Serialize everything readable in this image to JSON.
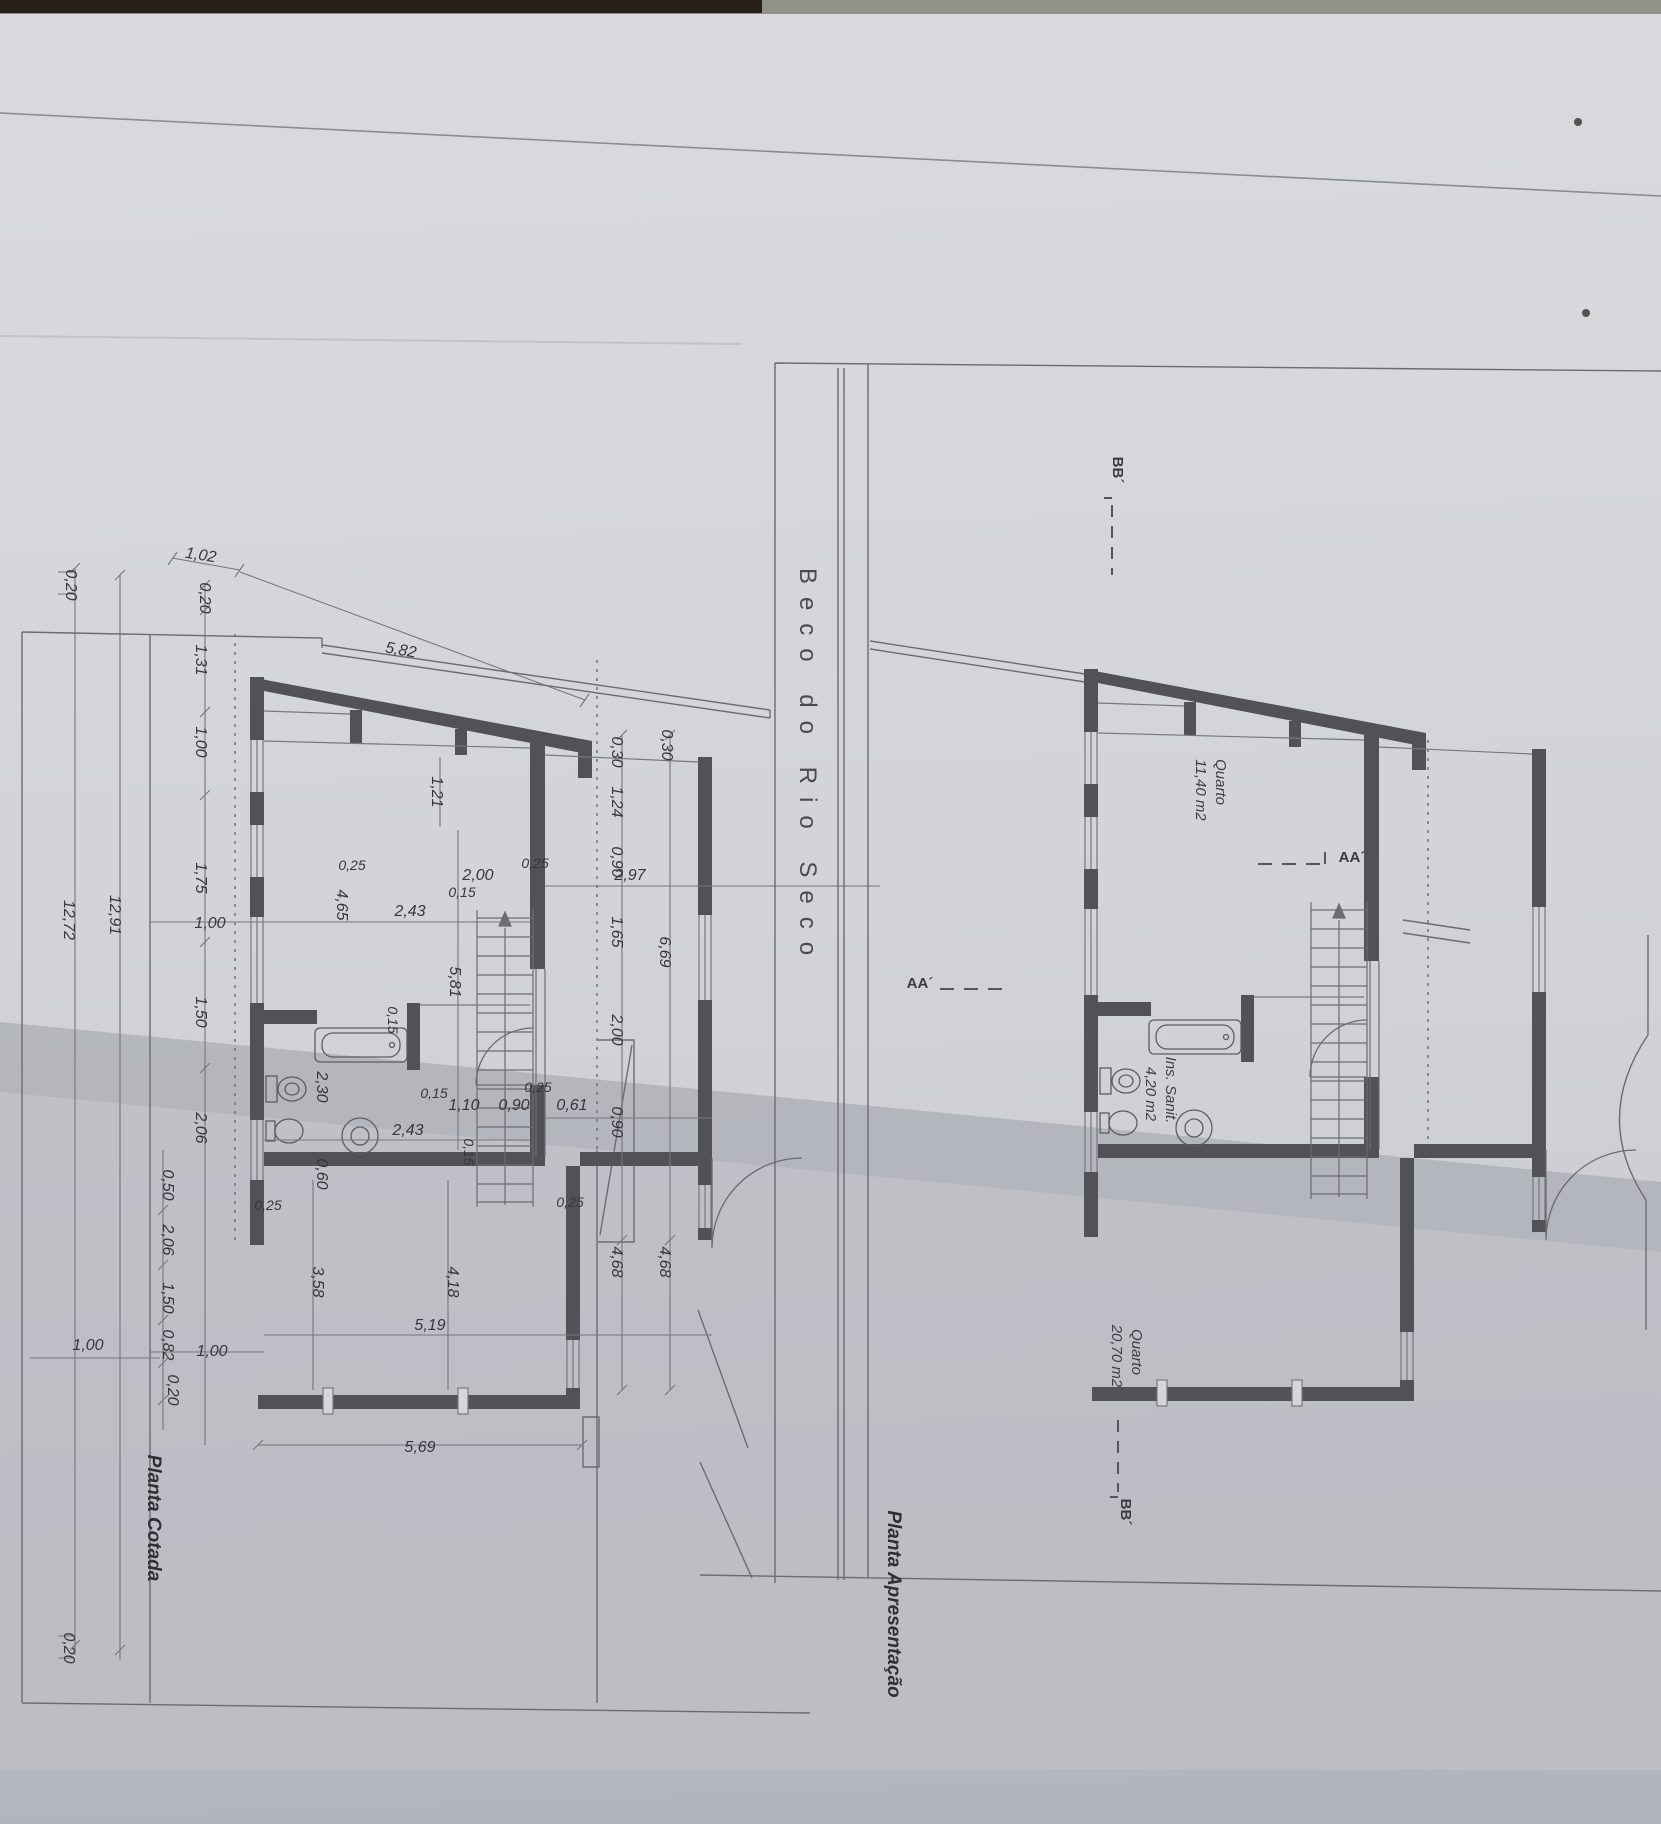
{
  "street": {
    "name": "Beco do Rio Seco"
  },
  "titles": {
    "left": "Planta Cotada",
    "right": "Planta Apresentação"
  },
  "sections": {
    "aa": "AA´",
    "bb": "BB´"
  },
  "right_plan": {
    "rooms": [
      {
        "name": "Quarto",
        "area": "11,40 m2"
      },
      {
        "name": "Ins. Sanit.",
        "area": "4,20 m2"
      },
      {
        "name": "Quarto",
        "area": "20,70 m2"
      }
    ]
  },
  "left_plan": {
    "top_dims": [
      "1,02",
      "5,82"
    ],
    "left_chain": [
      "0,20",
      "1,31",
      "1,00",
      "1,75",
      "1,50",
      "2,06",
      "0,50",
      "2,06",
      "1,50",
      "0,82",
      "0,20"
    ],
    "edge_dims": [
      "0,20",
      "0,20"
    ],
    "totals": [
      "12,91",
      "12,72"
    ],
    "row_upper": [
      "1,00",
      "0,25",
      "4,65",
      "2,43",
      "0,15",
      "2,00",
      "0,25",
      "2,97"
    ],
    "right_chain": [
      "0,30",
      "1,24",
      "0,90",
      "1,65",
      "2,00",
      "0,90",
      "4,68"
    ],
    "right_chain2": [
      "0,30",
      "6,69",
      "4,68"
    ],
    "mid_dims": [
      "1,21",
      "5,81"
    ],
    "bath_dims": [
      "2,30",
      "0,15",
      "2,43",
      "0,15",
      "1,10",
      "0,90",
      "0,25",
      "0,61",
      "0,60",
      "0,15"
    ],
    "bottom_dims": [
      "0,25",
      "1,00",
      "5,19",
      "0,25",
      "3,58",
      "4,18",
      "1,00",
      "5,69"
    ]
  },
  "colors": {
    "wall": "#515156",
    "line": "#6b6c71",
    "paper": "#d5d6da",
    "fold_shadow": "#b2b5bb",
    "top_strip_dark": "#271f19",
    "top_strip_green": "#8e9289"
  }
}
